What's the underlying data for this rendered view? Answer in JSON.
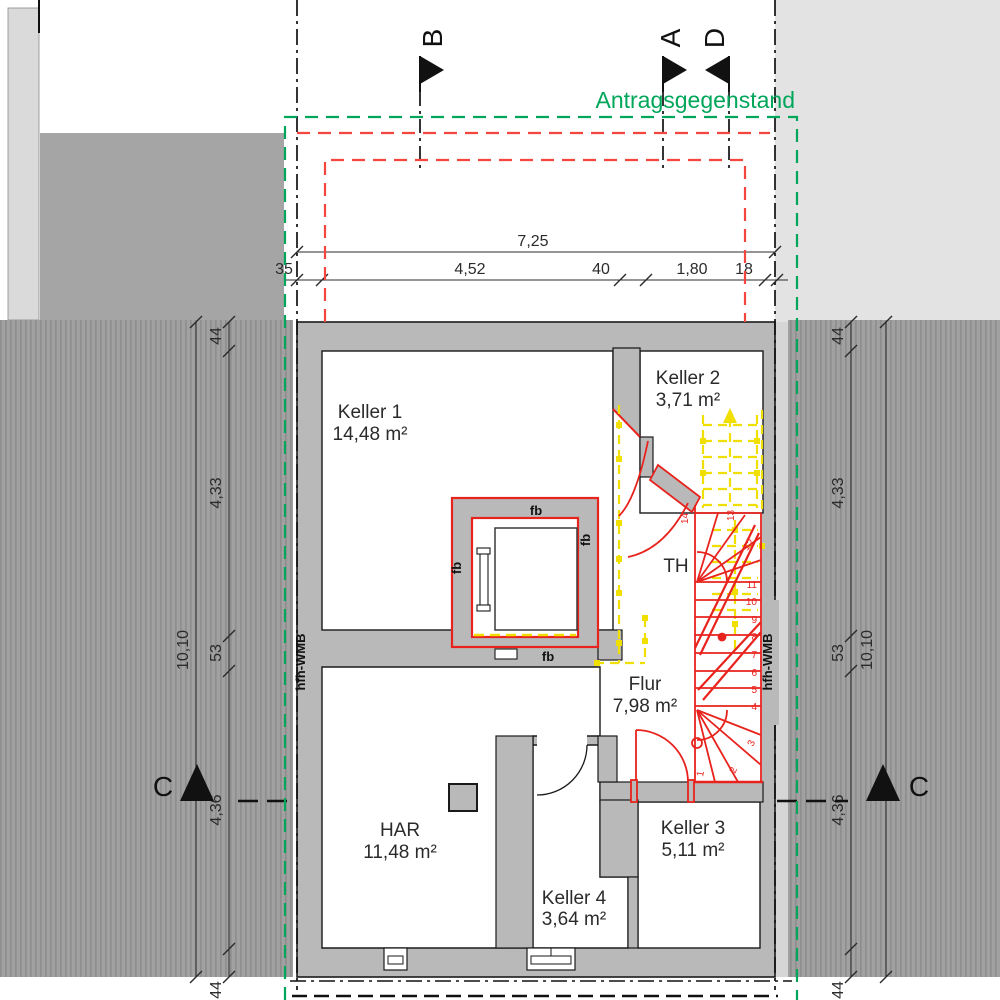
{
  "title": "Antragsgegenstand",
  "section_markers": {
    "a": "A",
    "b": "B",
    "d": "D",
    "c_left": "C",
    "c_right": "C"
  },
  "axis_labels": {
    "left": "hfh-WMB",
    "right": "hfh-WMB"
  },
  "rooms": {
    "keller1": {
      "name": "Keller 1",
      "area": "14,48 m²"
    },
    "keller2": {
      "name": "Keller 2",
      "area": "3,71 m²"
    },
    "keller3": {
      "name": "Keller 3",
      "area": "5,11 m²"
    },
    "keller4": {
      "name": "Keller 4",
      "area": "3,64 m²"
    },
    "flur": {
      "name": "Flur",
      "area": "7,98 m²"
    },
    "har": {
      "name": "HAR",
      "area": "11,48 m²"
    },
    "th": {
      "name": "TH"
    }
  },
  "fire_labels": {
    "top": "fb",
    "right": "fb",
    "left": "fb",
    "bottom": "fb"
  },
  "dimensions": {
    "top_total": "7,25",
    "top_segments": [
      "35",
      "4,52",
      "40",
      "1,80",
      "18"
    ],
    "left_total": "10,10",
    "left_segments": [
      "44",
      "4,33",
      "53",
      "4,36",
      "44"
    ],
    "right_total": "10,10",
    "right_segments": [
      "44",
      "4,33",
      "53",
      "4,36",
      "44"
    ]
  },
  "stair_steps": [
    "1",
    "2",
    "3",
    "4",
    "5",
    "6",
    "7",
    "8",
    "9",
    "10",
    "11",
    "12",
    "13",
    "14"
  ],
  "colors": {
    "proposal_green": "#00a65a",
    "demolition_yellow": "#f0df00",
    "new_construction_red": "#e8231d",
    "dashed_red": "#f4453f",
    "wall_gray": "#b9b9b9"
  }
}
